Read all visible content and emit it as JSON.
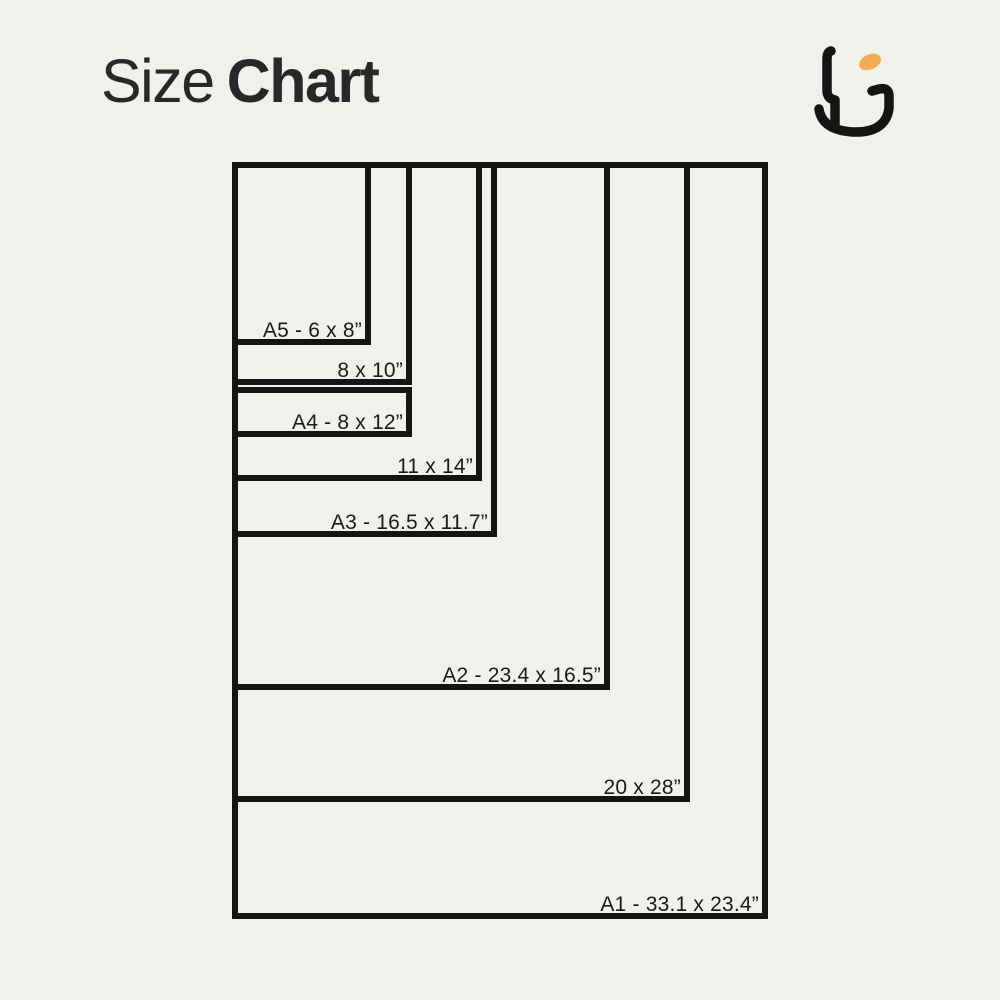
{
  "page": {
    "background_color": "#F1F0EA",
    "ink_color": "#141414"
  },
  "header": {
    "title_regular": "Size",
    "title_bold": "Chart",
    "logo": {
      "name": "brand-monogram",
      "ink_color": "#1C1C1E",
      "accent_color": "#F2AC55"
    }
  },
  "chart_data": {
    "type": "nested-rectangle-size-chart",
    "title": "Size Chart",
    "unit": "inches",
    "canvas_px": {
      "w": 1000,
      "h": 1000
    },
    "origin_px": {
      "x": 232,
      "y": 162
    },
    "label_inset_px": {
      "right": 9,
      "above_bottom": 25
    },
    "sizes": [
      {
        "id": "a1",
        "label": "A1 - 33.1 x 23.4”",
        "width_in": 23.4,
        "height_in": 33.1,
        "px": {
          "w": 536,
          "h": 757
        }
      },
      {
        "id": "20x28",
        "label": "20 x 28”",
        "width_in": 20,
        "height_in": 28,
        "px": {
          "w": 458,
          "h": 640
        }
      },
      {
        "id": "a2",
        "label": "A2 - 23.4 x 16.5”",
        "width_in": 16.5,
        "height_in": 23.4,
        "px": {
          "w": 378,
          "h": 528
        }
      },
      {
        "id": "a3",
        "label": "A3 - 16.5 x 11.7”",
        "width_in": 11.7,
        "height_in": 16.5,
        "px": {
          "w": 265,
          "h": 375
        }
      },
      {
        "id": "11x14",
        "label": "11 x 14”",
        "width_in": 11,
        "height_in": 14,
        "px": {
          "w": 250,
          "h": 319
        }
      },
      {
        "id": "8x10",
        "label": "8 x 10”",
        "width_in": 8,
        "height_in": 10,
        "px": {
          "w": 180,
          "h": 223
        }
      },
      {
        "id": "a4",
        "label": "A4 - 8 x 12”",
        "width_in": 8,
        "height_in": 12,
        "px": {
          "w": 180,
          "h": 50
        },
        "band_top_px": 387
      },
      {
        "id": "a5",
        "label": "A5 - 6 x 8”",
        "width_in": 6,
        "height_in": 8,
        "px": {
          "w": 139,
          "h": 183
        }
      }
    ]
  }
}
